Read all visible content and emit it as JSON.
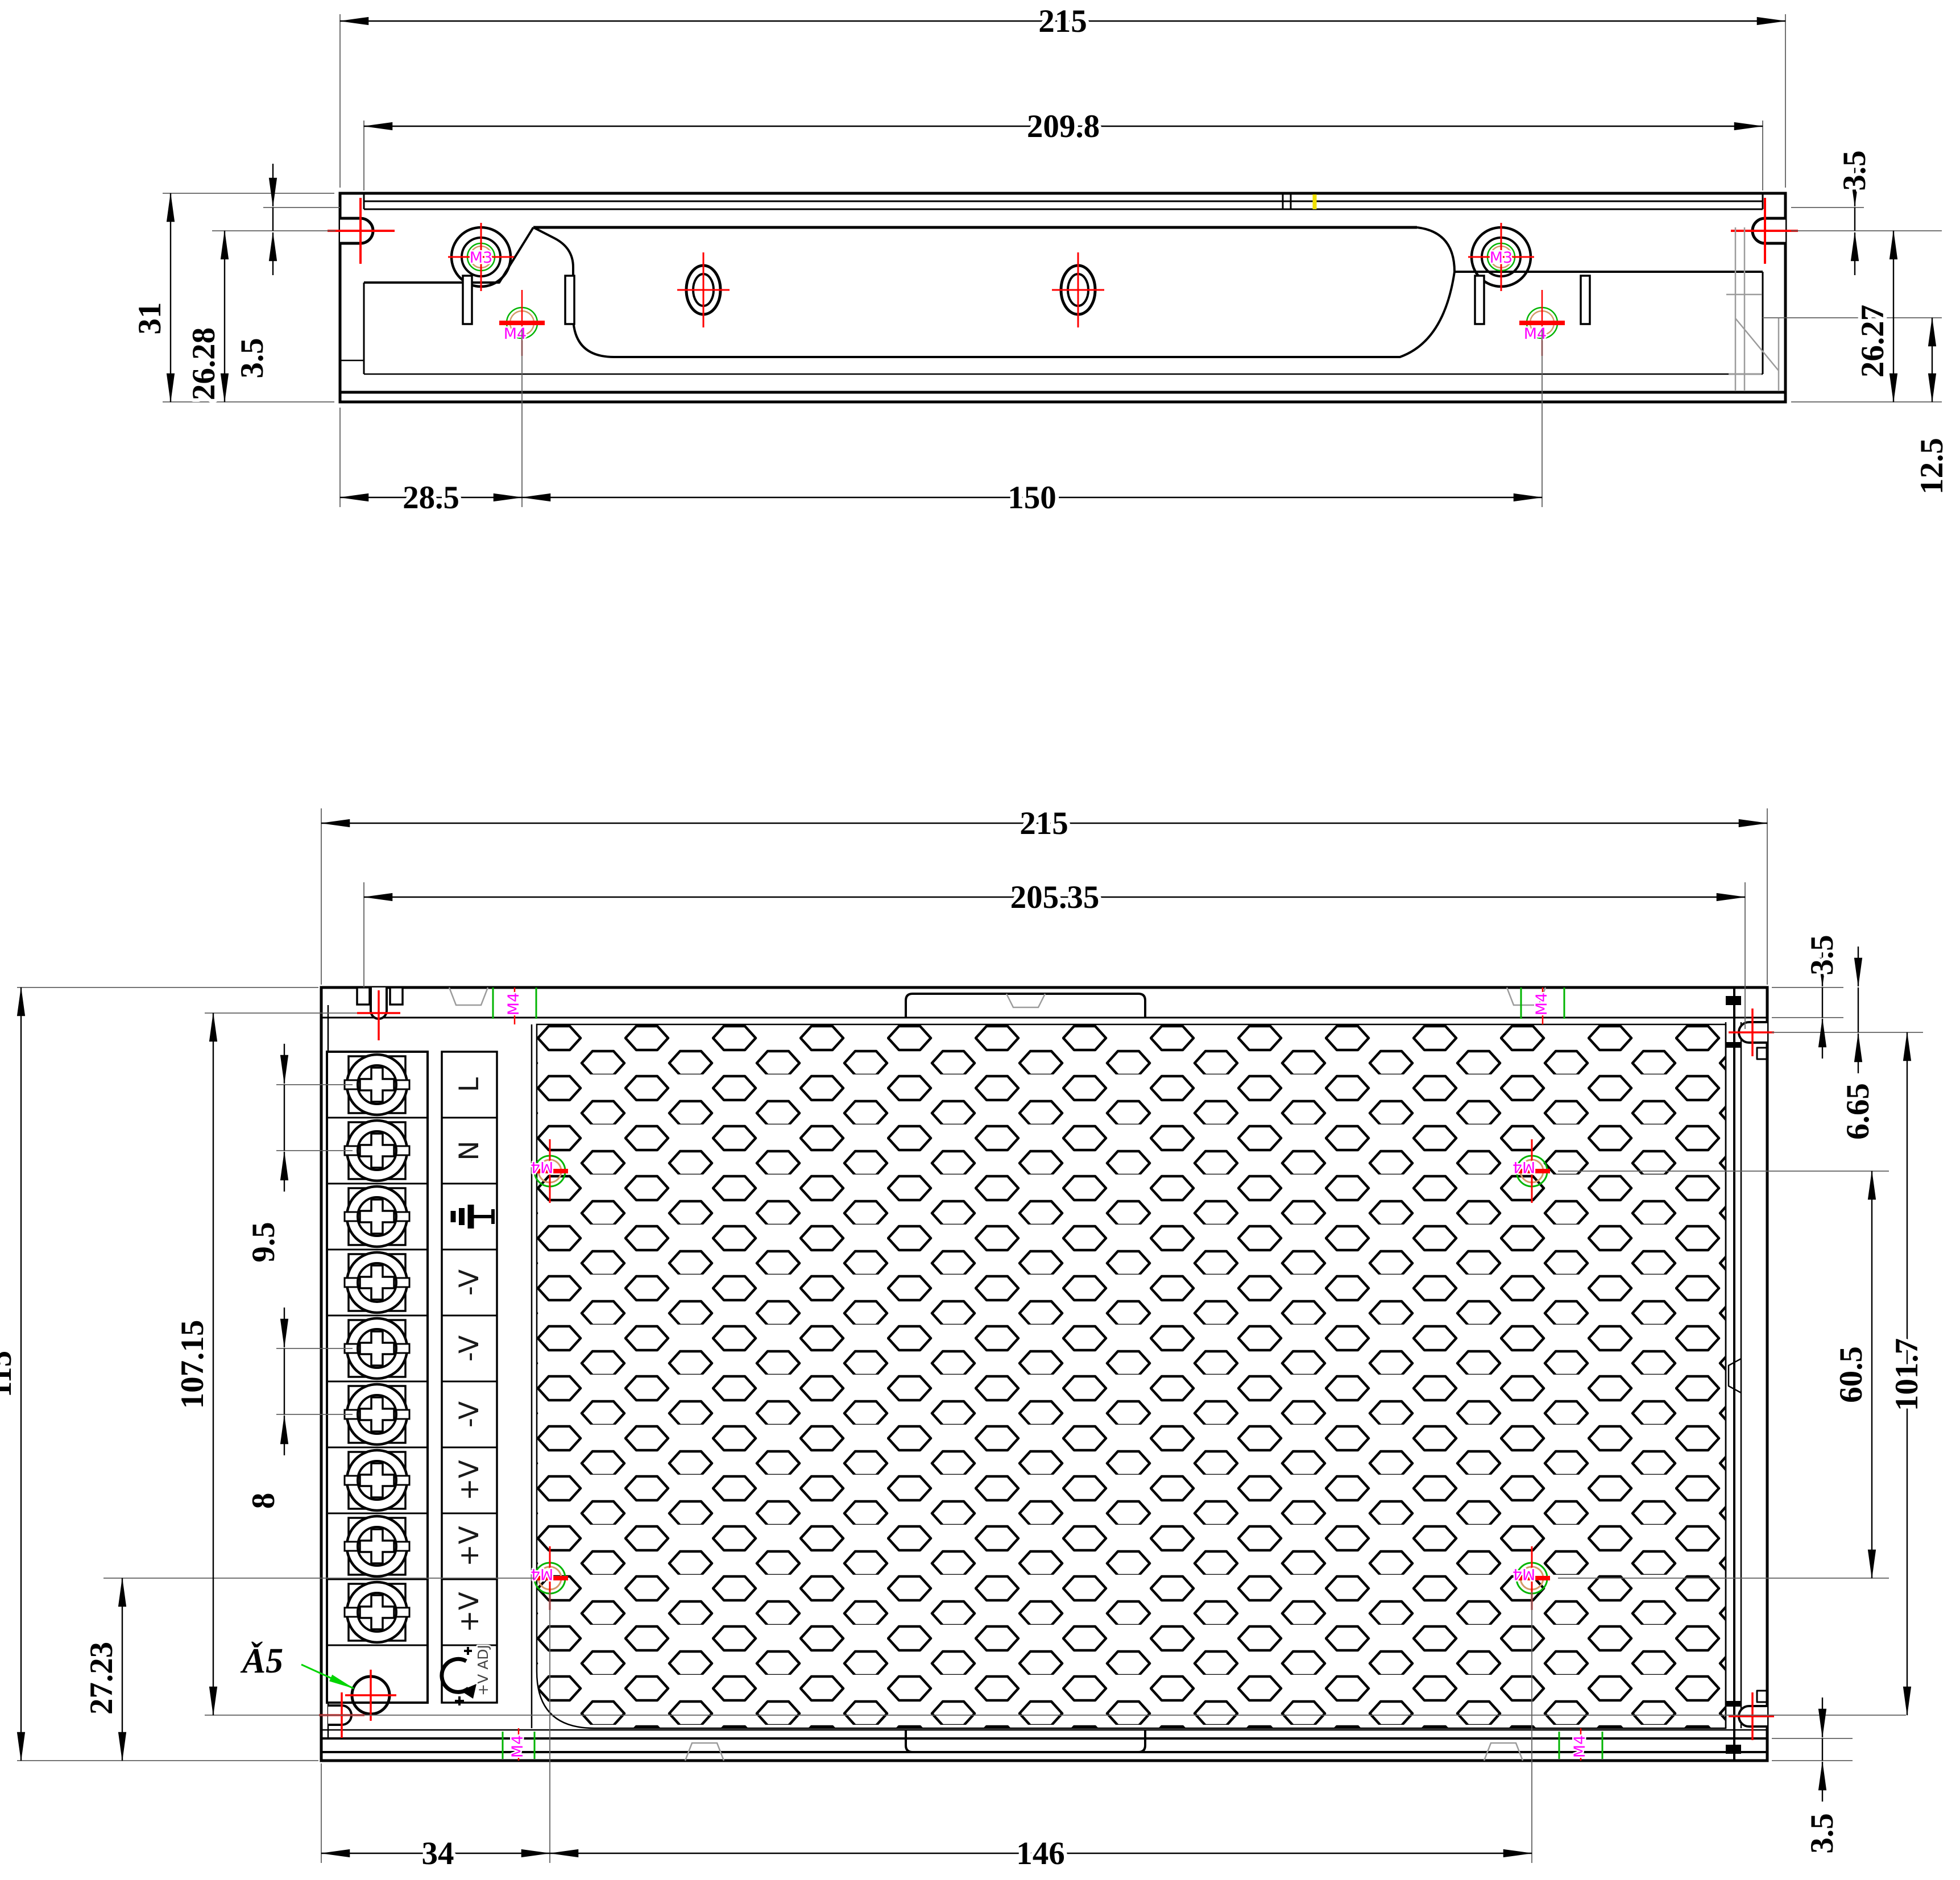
{
  "drawing": {
    "side_view": {
      "dims": {
        "overall_width": "215",
        "flange_width": "209.8",
        "overall_height": "31",
        "slot_to_bottom_left": "26.28",
        "top_to_slot_left": "3.5",
        "top_to_slot_right": "3.5",
        "slot_to_bottom_right": "26.27",
        "bracket_height": "12.5",
        "left_edge_to_hole": "28.5",
        "hole_spacing": "150"
      },
      "hole_labels": {
        "m3_left": "M3",
        "m3_right": "M3",
        "m4_left": "M4",
        "m4_right": "M4"
      }
    },
    "plan_view": {
      "dims": {
        "overall_width": "215",
        "inner_width": "205.35",
        "overall_height": "115",
        "terminal_span": "107.15",
        "input_terminal_pitch": "9.5",
        "output_terminal_pitch": "8",
        "hole_row_to_bottom": "27.23",
        "top_wall": "3.5",
        "top_to_side_slot": "6.65",
        "hole_row_spacing": "60.5",
        "side_slot_spacing": "101.7",
        "bottom_wall": "3.5",
        "left_edge_to_hole_column": "34",
        "hole_column_spacing": "146"
      },
      "hole_callout": "Ǎ5",
      "mesh_hole_labels": [
        "M4",
        "M4",
        "M4",
        "M4"
      ],
      "edge_hole_labels": [
        "M4",
        "M4",
        "M4",
        "M4"
      ]
    },
    "terminals": {
      "labels": [
        "L",
        "N",
        "⏚",
        "-V",
        "-V",
        "-V",
        "+V",
        "+V",
        "+V"
      ],
      "adjust_label": "+V ADJ"
    },
    "colors": {
      "outline": "#000000",
      "centerline": "#ff0000",
      "hole_mark_green": "#00b400",
      "hole_mark_orange": "#d49a6a",
      "thread_label": "#ff00ff",
      "seam_mark": "#f0e000",
      "hidden_line": "#9b9b9b",
      "background": "#ffffff"
    }
  }
}
